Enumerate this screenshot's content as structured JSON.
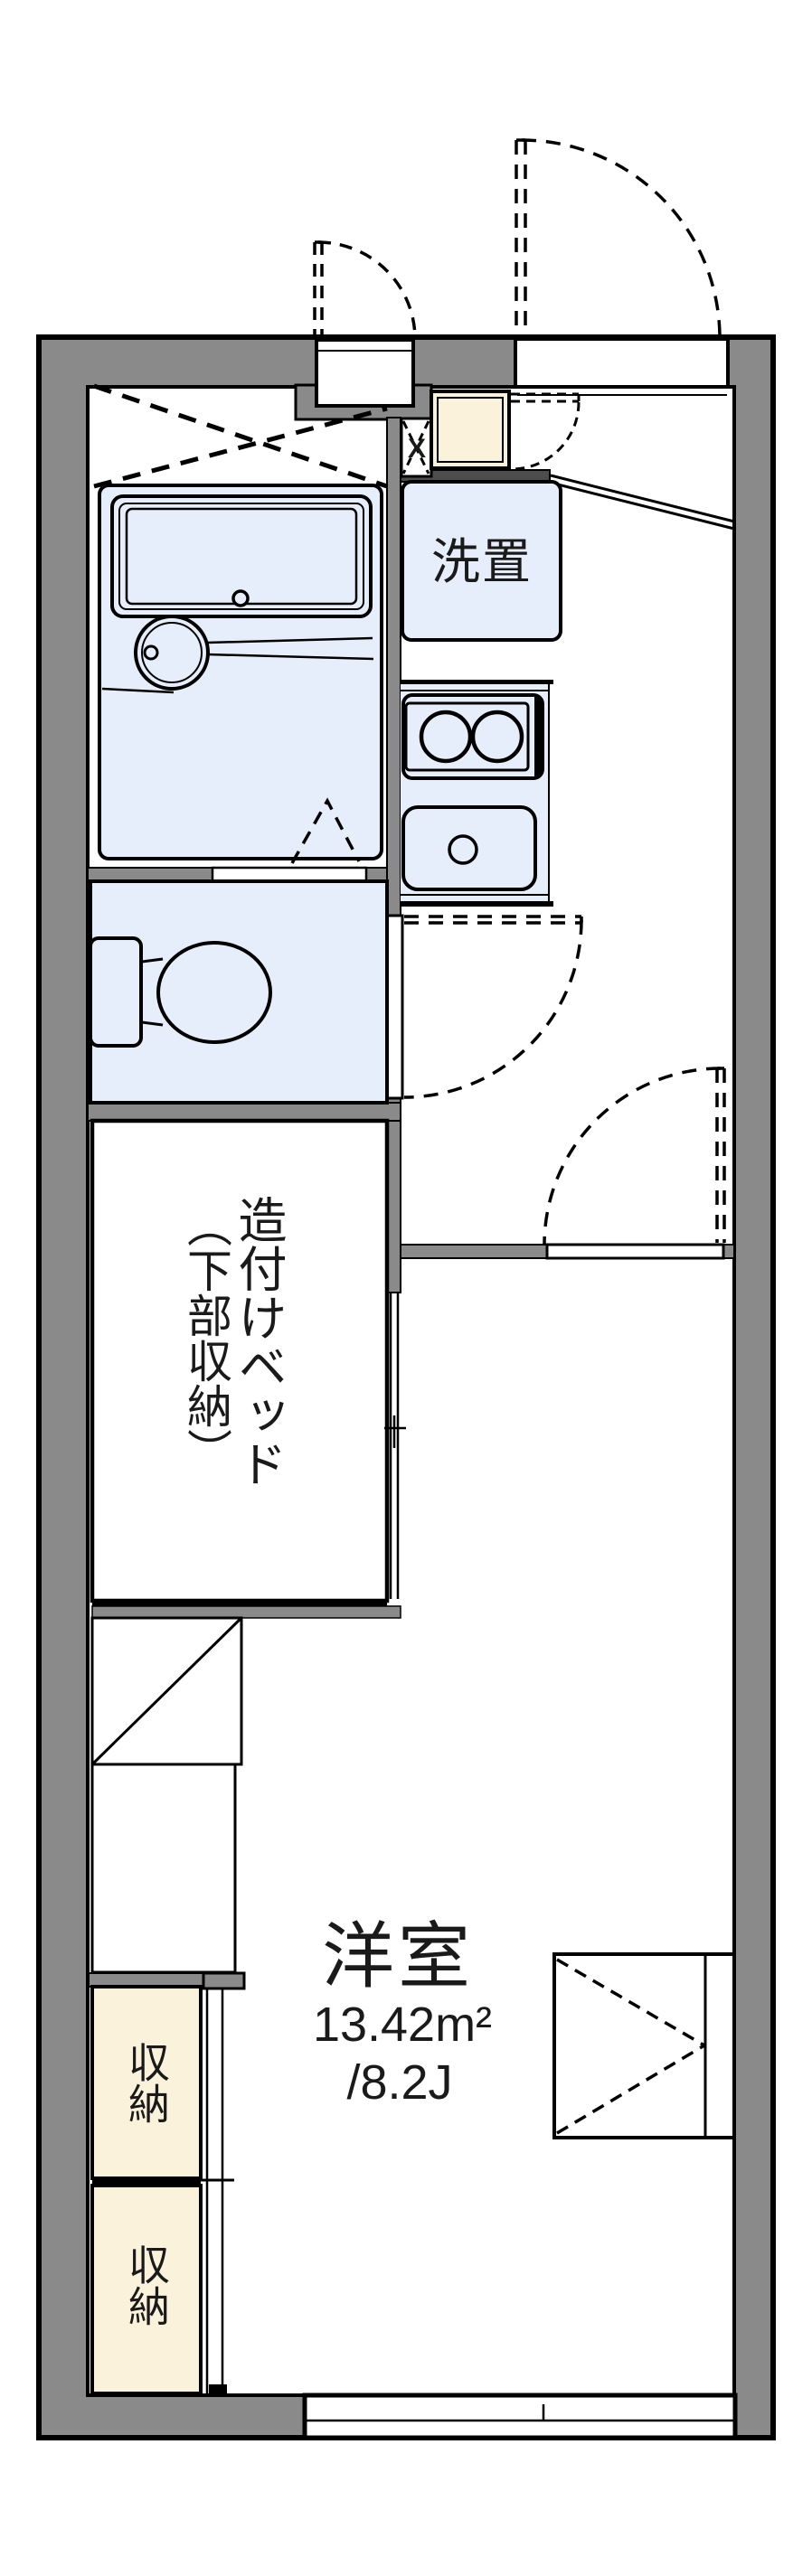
{
  "plan": {
    "labels": {
      "washer_area": "洗置",
      "built_in_bed_main": "造付けベッド",
      "built_in_bed_sub": "（下部収納）",
      "storage_1": "収納",
      "storage_2": "収納",
      "main_room_name": "洋室",
      "main_room_area_sqm": "13.42m²",
      "main_room_area_tatami": "/8.2J",
      "pipe_space_mark": "X"
    },
    "colors": {
      "wall_gray": "#8a8a8a",
      "dark_partition": "#4d4d4d",
      "wet_area_blue": "#e7eefb",
      "storage_cream": "#fbf2dc",
      "line_black": "#000000",
      "background": "#ffffff"
    }
  }
}
